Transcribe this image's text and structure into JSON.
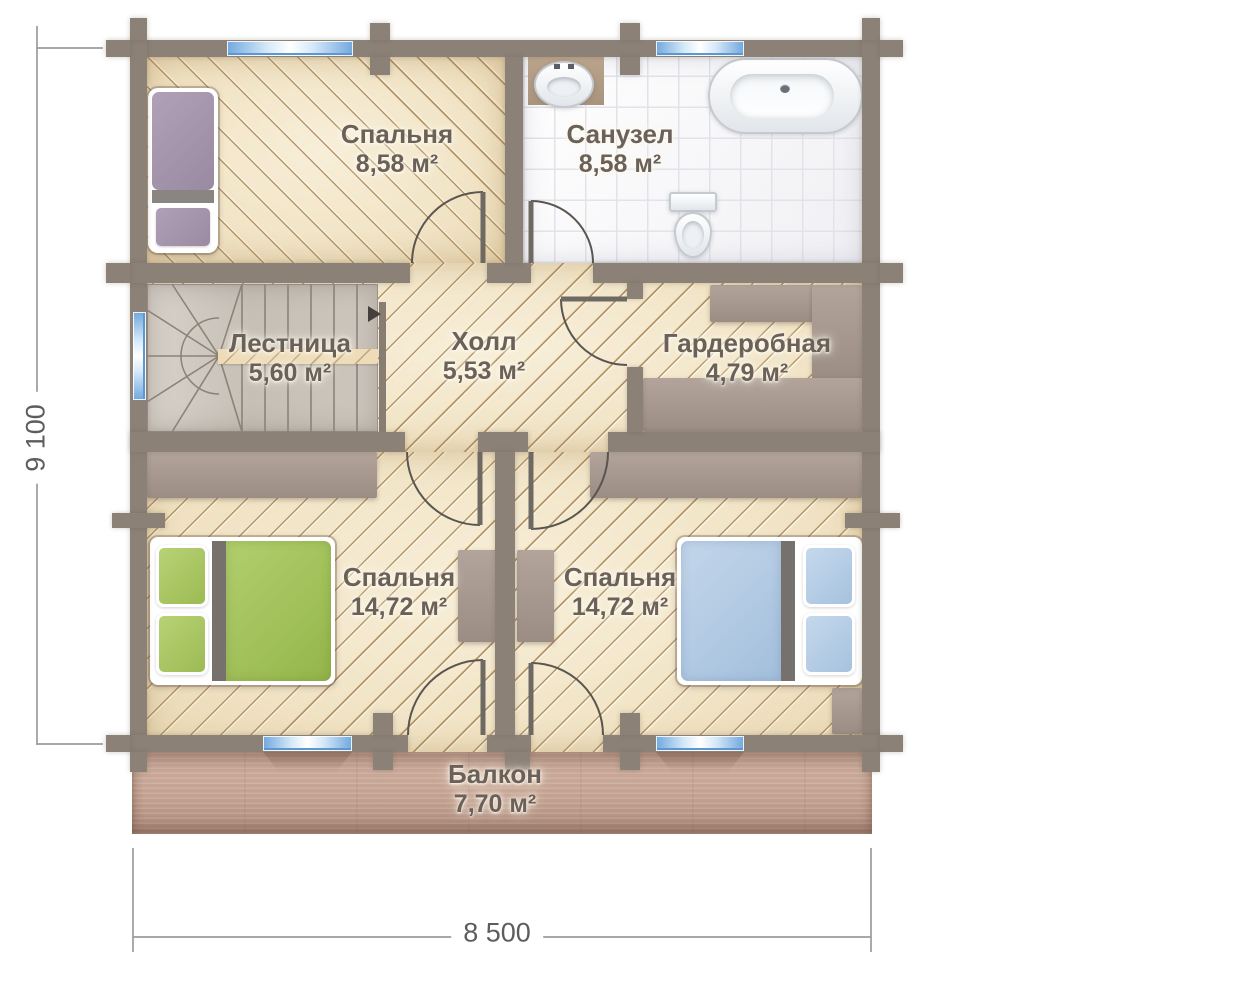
{
  "rooms": [
    {
      "id": "bedroom-top",
      "name": "Спальня",
      "area": "8,58 м²"
    },
    {
      "id": "bathroom",
      "name": "Санузел",
      "area": "8,58 м²"
    },
    {
      "id": "staircase",
      "name": "Лестница",
      "area": "5,60 м²"
    },
    {
      "id": "hall",
      "name": "Холл",
      "area": "5,53 м²"
    },
    {
      "id": "wardrobe",
      "name": "Гардеробная",
      "area": "4,79 м²"
    },
    {
      "id": "bedroom-left",
      "name": "Спальня",
      "area": "14,72 м²"
    },
    {
      "id": "bedroom-right",
      "name": "Спальня",
      "area": "14,72 м²"
    },
    {
      "id": "balcony",
      "name": "Балкон",
      "area": "7,70 м²"
    }
  ],
  "dimensions": {
    "height_label": "9 100",
    "width_label": "8 500"
  },
  "colors": {
    "wall": "#8c8177",
    "floor_beige": "#f2e6c9",
    "hatch": "#b08c54",
    "bathroom_tile": "#f7f7fa",
    "balcony_wood": "#c2a08e",
    "window_blue": "#74aadf",
    "bed_purple": "#a292aa",
    "bed_green": "#a3c55f",
    "bed_blue": "#b4cbe2",
    "furniture_grey": "#a0928a",
    "label_text": "#6b6159",
    "dimension_text": "#5d5d5d"
  }
}
